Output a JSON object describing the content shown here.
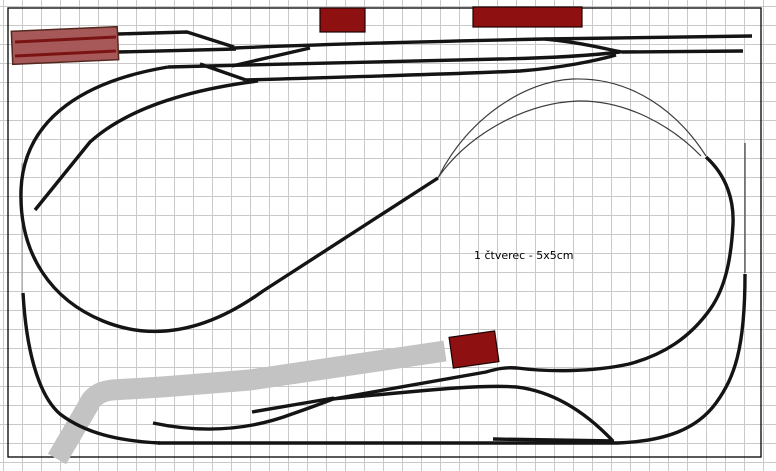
{
  "diagram": {
    "type": "model-railway-track-plan",
    "scale_label": "1 čtverec - 5x5cm",
    "scale_label_pos": {
      "x": 474,
      "y": 259
    },
    "grid": {
      "square_px": 19,
      "square_real": "5x5cm",
      "color": "#c9c9c9",
      "offset_x": 3,
      "offset_y": 6
    },
    "border": {
      "x": 8,
      "y": 8,
      "width": 753,
      "height": 449,
      "color": "#000000"
    },
    "colors": {
      "background": "#ffffff",
      "track": "#141414",
      "hidden_track": "#3c3c3c",
      "faint_track": "#9a9a9a",
      "building_fill": "#8e1010",
      "building_stroke": "#1a0303",
      "station_fill": "#a75858",
      "station_stroke": "#53281f",
      "station_track": "#7a1414",
      "road": "#c3c3c3",
      "label_text": "#000000"
    },
    "buildings": [
      {
        "name": "station-building-main",
        "x": 12,
        "y": 29,
        "width": 106,
        "height": 33,
        "rotation": -2.5,
        "type": "station"
      },
      {
        "name": "building-top-small",
        "x": 320,
        "y": 8,
        "width": 45,
        "height": 24,
        "rotation": 0,
        "type": "solid"
      },
      {
        "name": "building-top-long",
        "x": 473,
        "y": 7,
        "width": 109,
        "height": 20,
        "rotation": 0,
        "type": "solid"
      },
      {
        "name": "building-bottom",
        "x": 451,
        "y": 334,
        "width": 46,
        "height": 31,
        "rotation": -8,
        "type": "solid"
      }
    ],
    "road": {
      "path": "M 57,459 L 88,406 Q 94,392 112,390 L 162,387 L 250,380 L 445,351",
      "width": 21
    },
    "tracks": {
      "main": [
        "M 118,34 L 187,32 L 234,47",
        "M 118,52 L 236,49",
        "M 234,48 C 330,44 450,41 545,39 L 752,36",
        "M 545,39 C 585,43 605,49 622,52 L 743,51",
        "M 168,67 C 280,64 420,61 500,59 C 550,58 595,55 620,52",
        "M 232,66 L 310,48",
        "M 200,64 L 246,80",
        "M 246,80 C 340,77 460,74 520,71 C 560,68 595,61 616,55",
        "M 258,81 C 195,89 130,106 90,142 L 35,210",
        "M 168,67 C 90,80 24,115 21,190 C 19,255 52,300 103,321 C 152,341 205,333 263,291 L 438,178",
        "M 23,293 C 26,346 37,394 60,414 C 85,433 118,441 160,443",
        "M 158,443 L 618,443 C 666,441 697,429 716,403 C 734,378 745,350 745,274",
        "M 706,157 C 727,176 734,201 733,224 C 731,263 724,289 711,308 C 690,338 663,355 629,364 C 593,372 549,372 517,368 C 505,367 496,369 486,372 L 333,399",
        "M 153,423 C 205,434 252,429 292,414 C 312,407 323,403 333,399",
        "M 252,412 L 334,398",
        "M 333,399 C 410,392 478,384 517,387 C 558,392 590,417 612,440",
        "M 493,439 L 614,441"
      ],
      "thin": [
        "M 439,176 C 468,118 525,81 573,79 C 632,77 678,112 706,156",
        "M 437,179 C 468,134 525,103 578,101 C 626,100 672,126 701,156",
        "M 745,143 L 745,273"
      ],
      "faint": [
        "M 22,163 L 22,293"
      ],
      "station_lines": [
        "M 15,42 L 116,37",
        "M 15,56 L 116,51"
      ]
    }
  }
}
